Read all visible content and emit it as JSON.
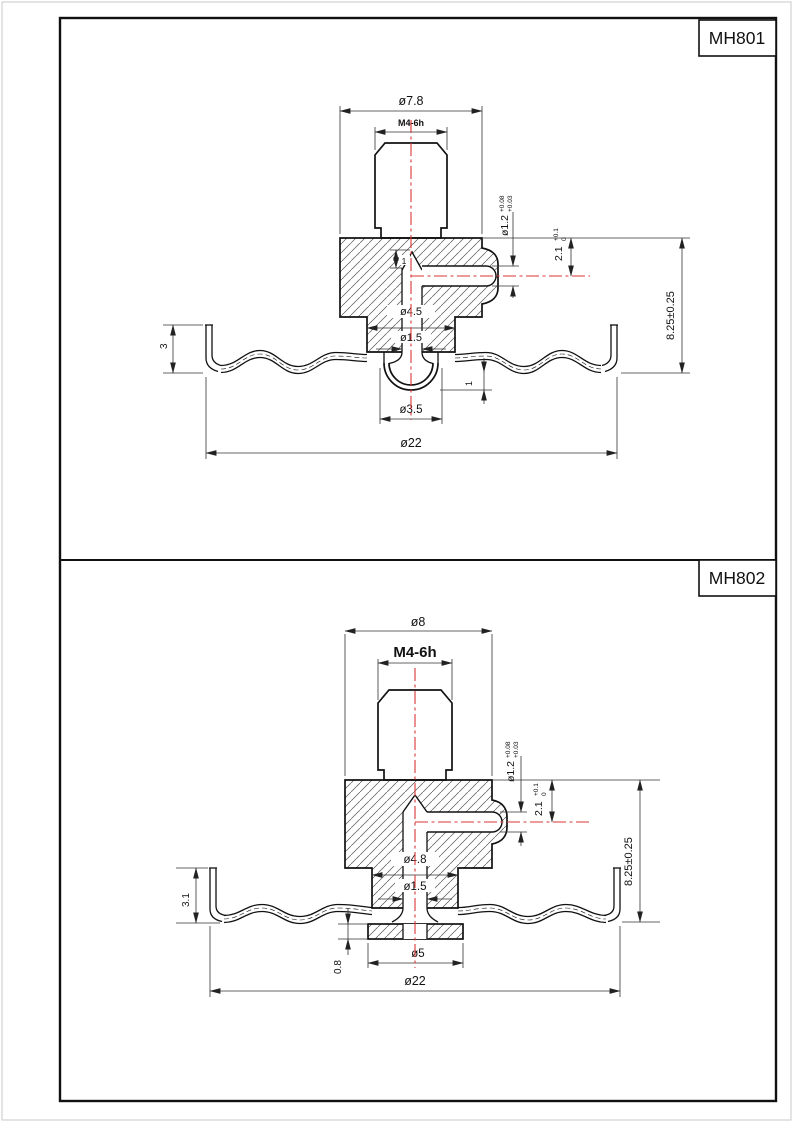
{
  "sheet": {
    "frame_color": "#111111",
    "centerline_color": "#d93636"
  },
  "drawings": [
    {
      "title": "MH801",
      "dims": {
        "hub_dia": "ø7.8",
        "thread": "M4-6h",
        "pin_hole_dia": "ø1.2",
        "pin_hole_tol_up": "+0.08",
        "pin_hole_tol_low": "+0.03",
        "pin_center_depth": "2.1",
        "pin_center_tol_up": "+0.1",
        "pin_center_tol_low": "0",
        "overall_height": "8.25±0.25",
        "counterbore_dia": "ø4.5",
        "bore_dia": "ø1.5",
        "rim_height": "3",
        "cone_depth": "1",
        "dome_offset": "1",
        "dome_dia": "ø3.5",
        "disc_dia": "ø22"
      }
    },
    {
      "title": "MH802",
      "dims": {
        "hub_dia": "ø8",
        "thread": "M4-6h",
        "pin_hole_dia": "ø1.2",
        "pin_hole_tol_up": "+0.08",
        "pin_hole_tol_low": "+0.03",
        "pin_center_depth": "2.1",
        "pin_center_tol_up": "+0.1",
        "pin_center_tol_low": "0",
        "overall_height": "8.25±0.25",
        "counterbore_dia": "ø4.8",
        "bore_dia": "ø1.5",
        "rim_height": "3.1",
        "boss_height": "0.8",
        "boss_dia": "ø5",
        "disc_dia": "ø22"
      }
    }
  ]
}
